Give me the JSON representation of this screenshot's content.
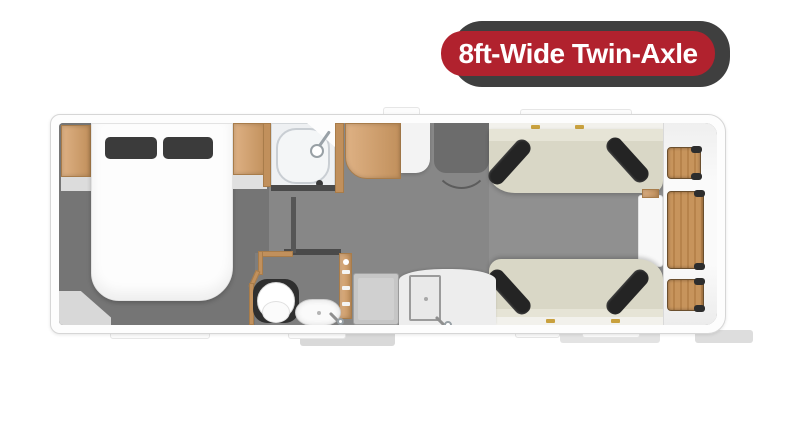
{
  "badge": {
    "label": "8ft-Wide Twin-Axle"
  },
  "colors": {
    "badge_bg": "#b1222e",
    "badge_text": "#ffffff",
    "badge_shadow": "#3f3f3f",
    "wood": "#deb184",
    "wood_dark": "#c1905c",
    "sofa": "#d9d7c6",
    "sofa_light": "#e6e4d6",
    "cushion": "#242424",
    "floor_bedroom": "#757575",
    "floor_mid": "#878787",
    "floor_lounge": "#909090",
    "floor_mat": "#6c6c6c",
    "wall": "#fdfdfd"
  },
  "floorplan": {
    "type": "caravan-layout-top-view",
    "rooms": [
      "bedroom",
      "shower-room",
      "washroom",
      "kitchen",
      "lounge"
    ],
    "furniture": [
      "double-bed",
      "pillows",
      "wardrobe",
      "overhead-locker",
      "corner-unit",
      "shower-tray",
      "shower-head",
      "toilet",
      "wash-basin",
      "slatted-door",
      "kitchen-unit",
      "kitchen-sink",
      "entrance-mat",
      "sofa-top",
      "sofa-bottom",
      "bolster-cushions",
      "side-chest",
      "front-chest-tables"
    ]
  }
}
